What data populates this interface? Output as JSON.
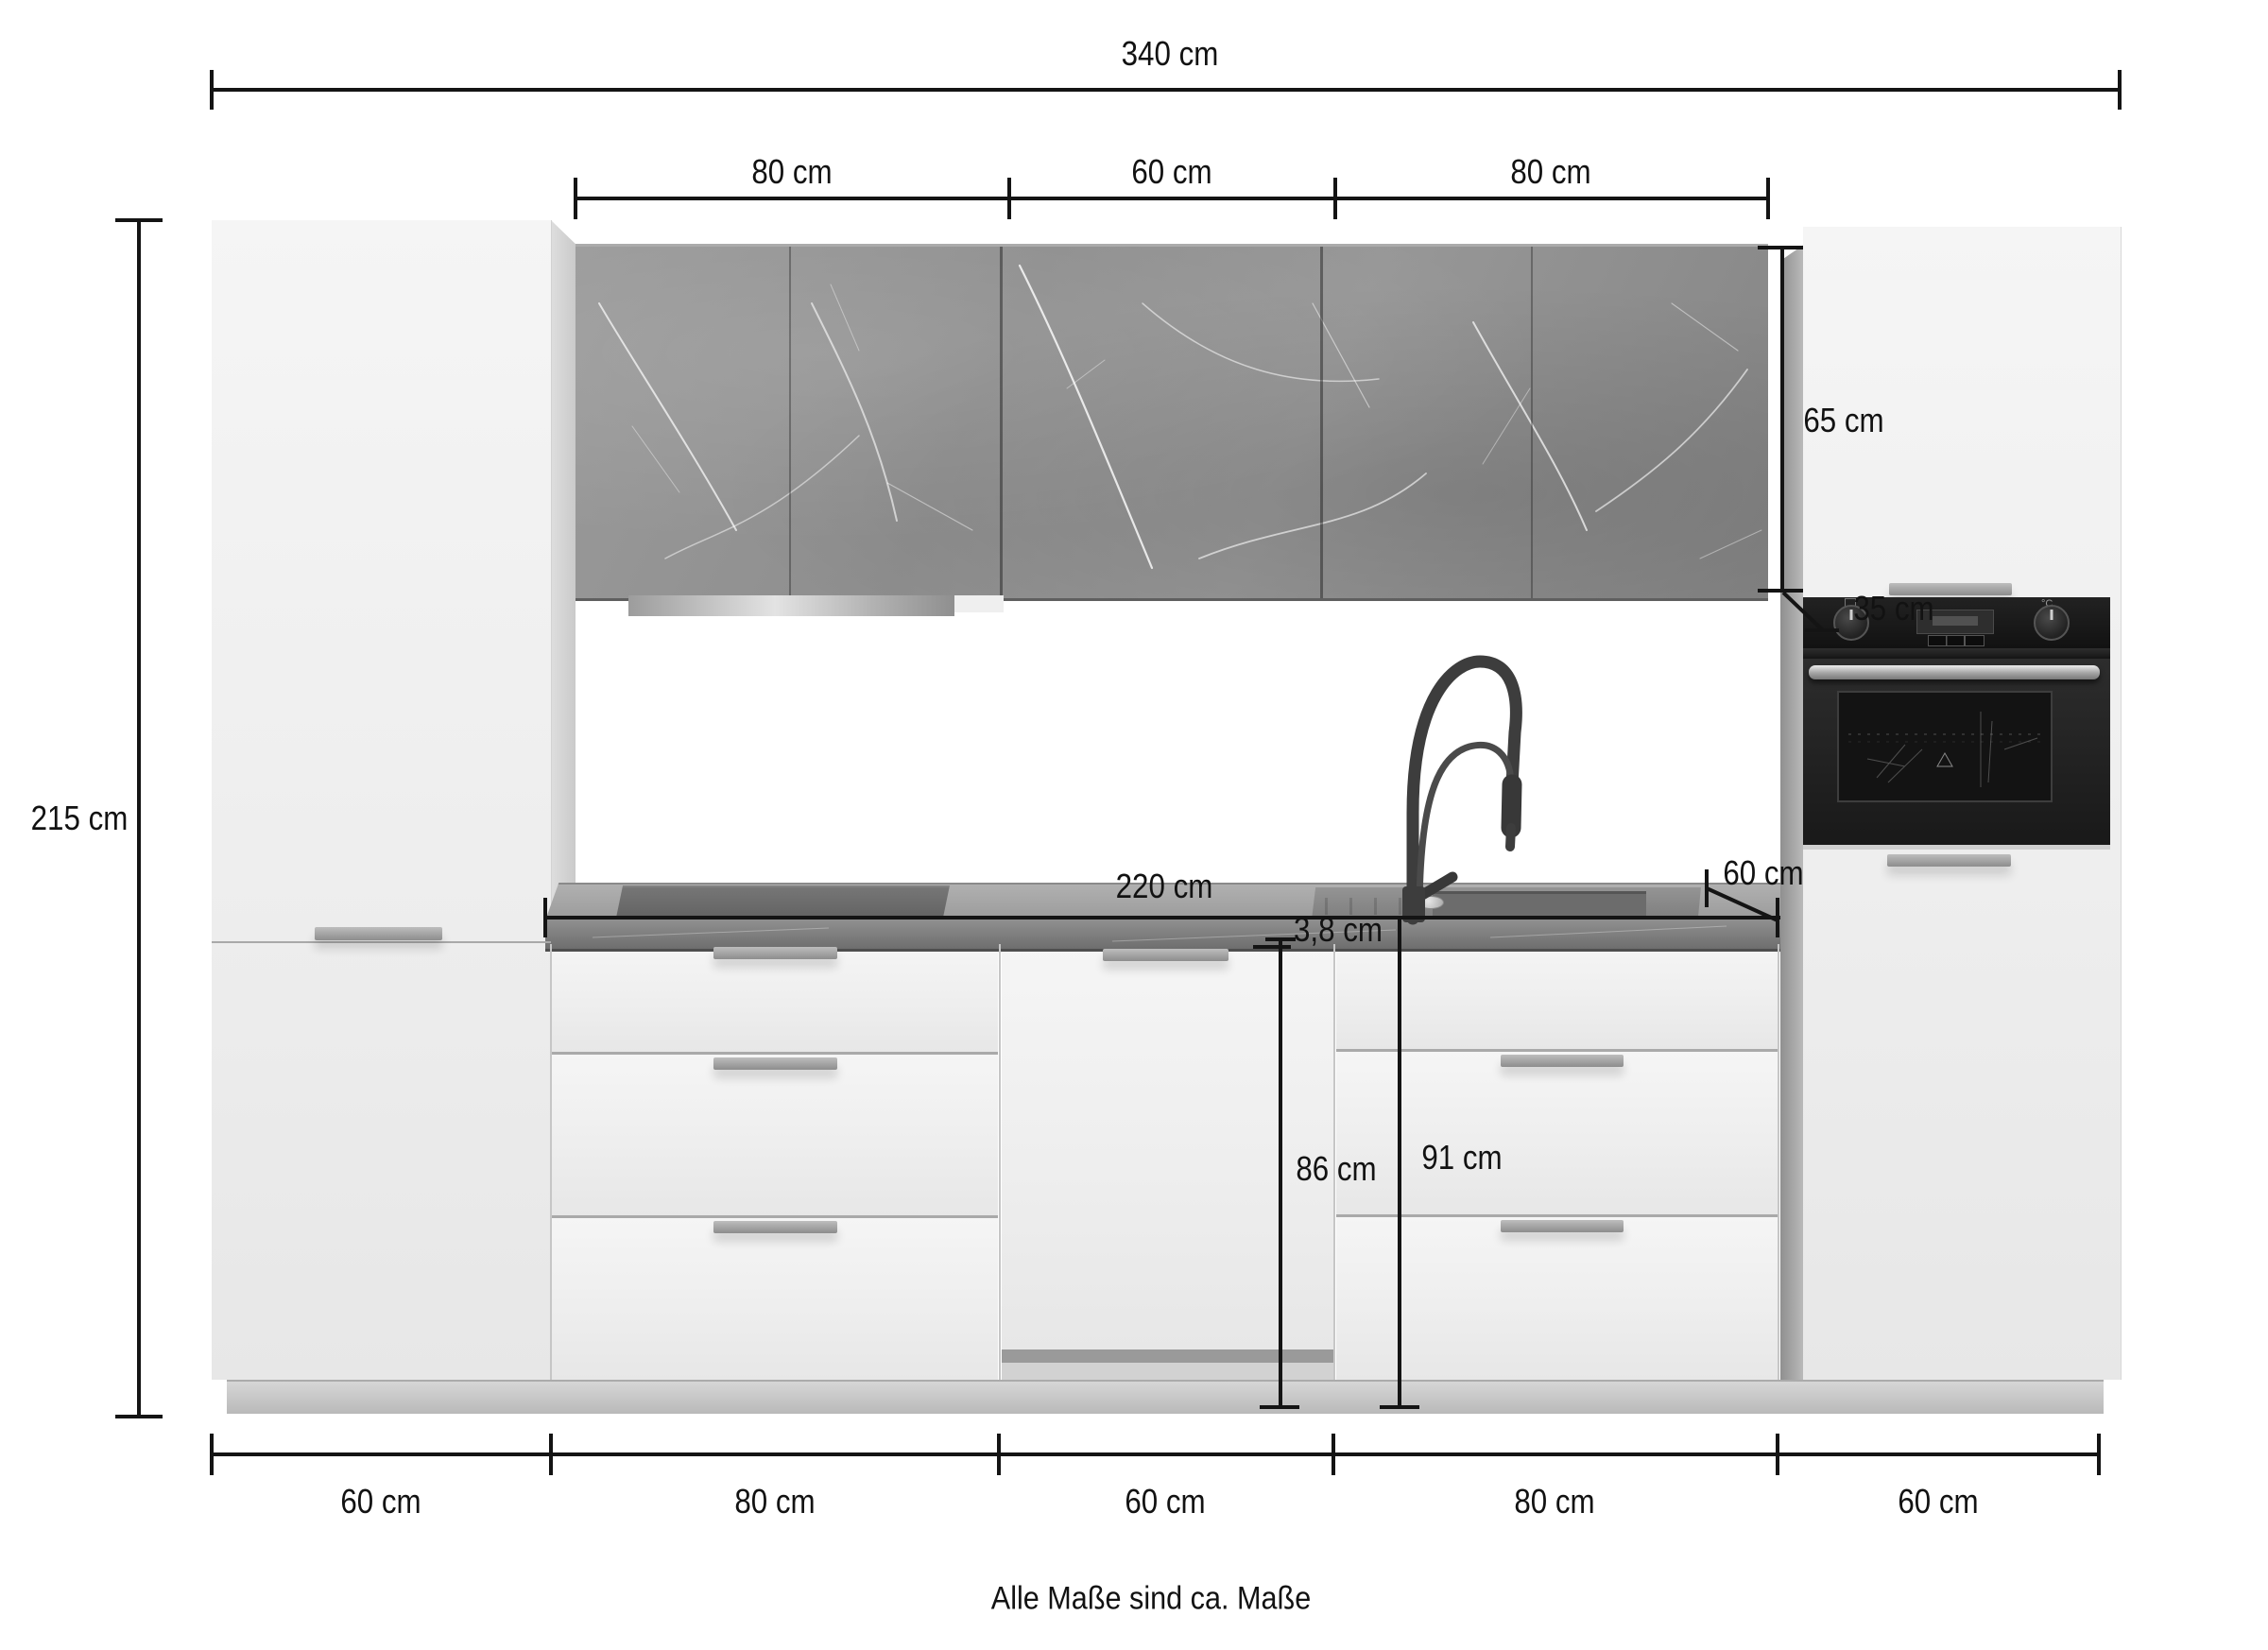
{
  "dims": {
    "total_width": "340 cm",
    "upper_segments": [
      "80 cm",
      "60 cm",
      "80 cm"
    ],
    "total_height": "215 cm",
    "wall_cabinet_height": "65 cm",
    "wall_cabinet_depth": "35 cm",
    "worktop_length": "220 cm",
    "worktop_depth": "60 cm",
    "worktop_thickness": "3,8 cm",
    "base_front_height": "86 cm",
    "base_total_height": "91 cm",
    "bottom_segments": [
      "60 cm",
      "80 cm",
      "60 cm",
      "80 cm",
      "60 cm"
    ]
  },
  "footnote": "Alle Maße sind ca. Maße",
  "oven": {
    "temp_unit": "°C"
  },
  "colors": {
    "dim_line": "#141414",
    "cabinet_front": "#f2f2f2",
    "marble_wall_cabinet": "#8f8f8f",
    "worktop_front": "#7a7a7a",
    "oven_black": "#1a1a1a",
    "steel_handle": "#a8a8a8"
  }
}
